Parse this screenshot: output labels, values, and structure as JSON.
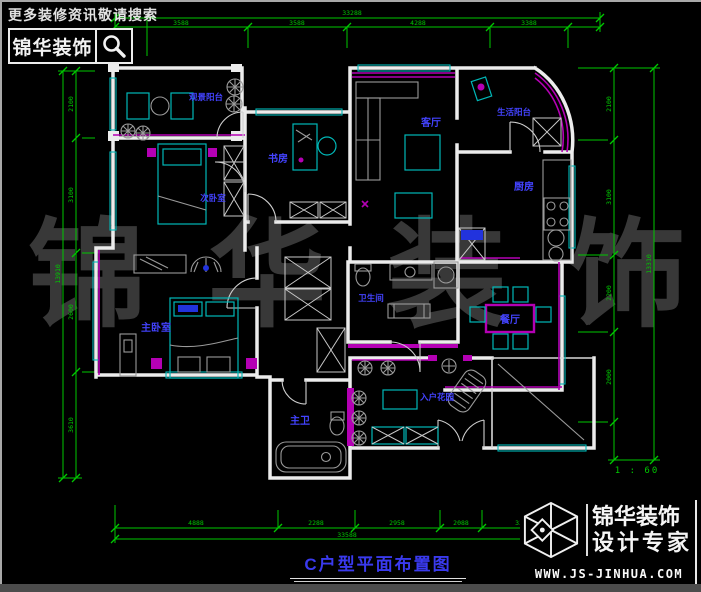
{
  "header": {
    "search_hint": "更多装修资讯敬请搜索",
    "logo_text": "锦华装饰"
  },
  "watermark": "锦华装饰",
  "title": "C户型平面布置图",
  "scale_label": "1 : 60",
  "footer": {
    "brand_line1": "锦华装饰",
    "brand_line2": "设计专家",
    "website": "WWW.JS-JINHUA.COM"
  },
  "rooms": [
    {
      "label": "观景阳台"
    },
    {
      "label": "次卧室"
    },
    {
      "label": "书房"
    },
    {
      "label": "客厅"
    },
    {
      "label": "生活阳台"
    },
    {
      "label": "厨房"
    },
    {
      "label": "主卧室"
    },
    {
      "label": "卫生间"
    },
    {
      "label": "餐厅"
    },
    {
      "label": "主卫"
    },
    {
      "label": "入户花园"
    }
  ],
  "dimensions": {
    "top": {
      "total": "33288",
      "segments": [
        "3588",
        "3588",
        "4288",
        "3388"
      ]
    },
    "bottom": {
      "total": "33588",
      "segments": [
        "4888",
        "2288",
        "2958",
        "2088",
        "3388"
      ]
    },
    "left": {
      "total": "13910",
      "segments": [
        "2100",
        "3100",
        "2600",
        "3610"
      ]
    },
    "right": {
      "total": "13310",
      "segments": [
        "2100",
        "3100",
        "2200",
        "2000"
      ]
    }
  },
  "colors": {
    "dimension_green": "#00c800",
    "wall_white": "#ececec",
    "furniture_cyan": "#00b8b8",
    "accent_magenta": "#b400b4",
    "room_label_blue": "#4343ff",
    "watermark_gray": "#383838"
  }
}
